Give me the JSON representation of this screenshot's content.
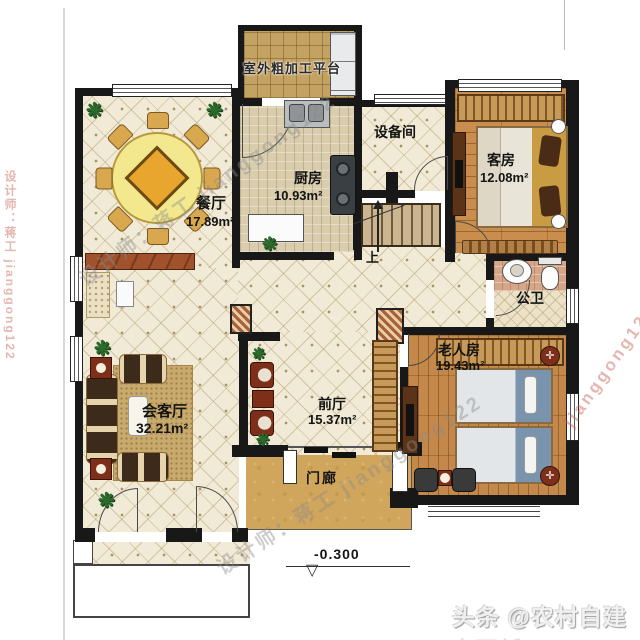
{
  "rooms": {
    "platform": {
      "name": "室外粗加工平台"
    },
    "dining": {
      "name": "餐厅",
      "area": "17.89m²"
    },
    "kitchen": {
      "name": "厨房",
      "area": "10.93m²"
    },
    "equipment": {
      "name": "设备间"
    },
    "guest": {
      "name": "客房",
      "area": "12.08m²"
    },
    "bath": {
      "name": "公卫"
    },
    "elder": {
      "name": "老人房",
      "area": "19.43m²"
    },
    "foyer": {
      "name": "前厅",
      "area": "15.37m²"
    },
    "living": {
      "name": "会客厅",
      "area": "32.21m²"
    },
    "porch": {
      "name": "门廊"
    }
  },
  "annotations": {
    "stairs_up": "上",
    "elevation": "-0.300"
  },
  "watermarks": {
    "designer": "设计师：蒋工 jianggong122",
    "id": "jianggong122",
    "brand": "头条 @农村自建房图纸"
  },
  "colors": {
    "wall": "#181818",
    "cream_tile": "#f1ead6",
    "wood_floor": "#c98e4e",
    "porch_gold": "#d0a55c",
    "watermark_gray": "#8a8a8a",
    "watermark_red": "#cd7a6e",
    "brand_white": "#f0f0f0"
  }
}
